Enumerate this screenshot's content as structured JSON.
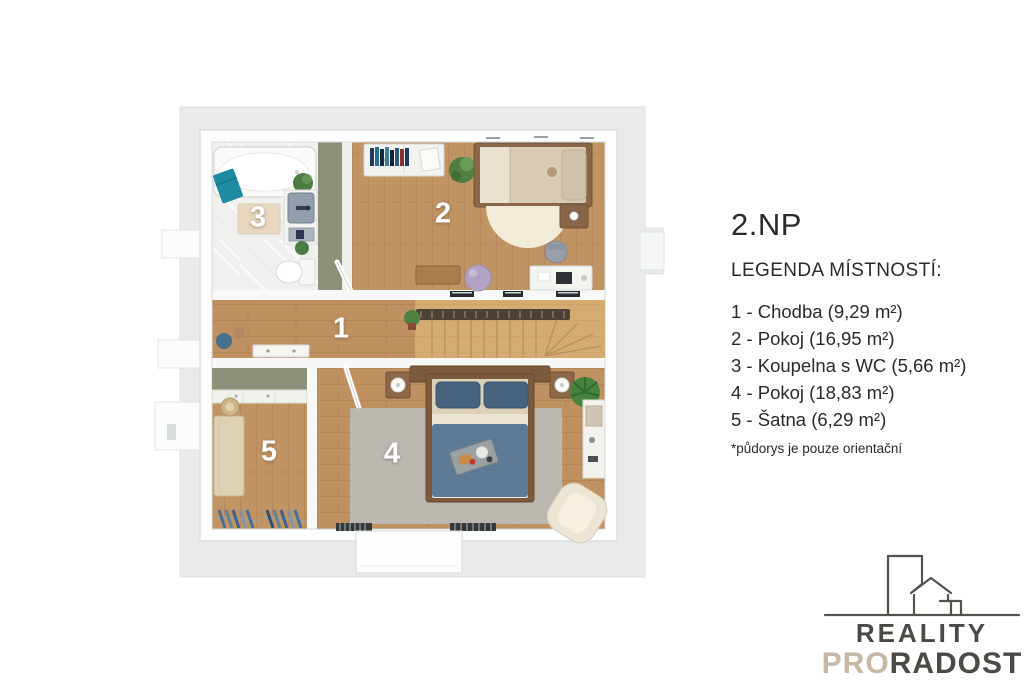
{
  "legend": {
    "floor_title": "2.NP",
    "subtitle": "LEGENDA MÍSTNOSTÍ:",
    "items": [
      "1 - Chodba (9,29 m²)",
      "2 - Pokoj (16,95 m²)",
      "3 - Koupelna s WC (5,66 m²)",
      "4 - Pokoj (18,83 m²)",
      "5 - Šatna (6,29 m²)"
    ],
    "footnote": "*půdorys je pouze orientační"
  },
  "floorplan": {
    "labels": {
      "hallway": "1",
      "bedroom2": "2",
      "bathroom": "3",
      "bedroom4": "4",
      "wardrobe": "5"
    }
  },
  "logo": {
    "line1": "REALITY",
    "line2_pro": "PRO",
    "line2_radost": "RADOST"
  },
  "colors": {
    "text": "#2b2b2b",
    "logo-dark": "#4b4a45",
    "logo-beige": "#c7b7a4",
    "wood": "#c19464",
    "wall": "#fcfdfd",
    "roof-gray": "#e9ebeb",
    "marble": "#f0f1ef",
    "olive-closet": "#8d9179",
    "towel-teal": "#1e8ba1",
    "duvet-blue": "#5d7b97"
  }
}
